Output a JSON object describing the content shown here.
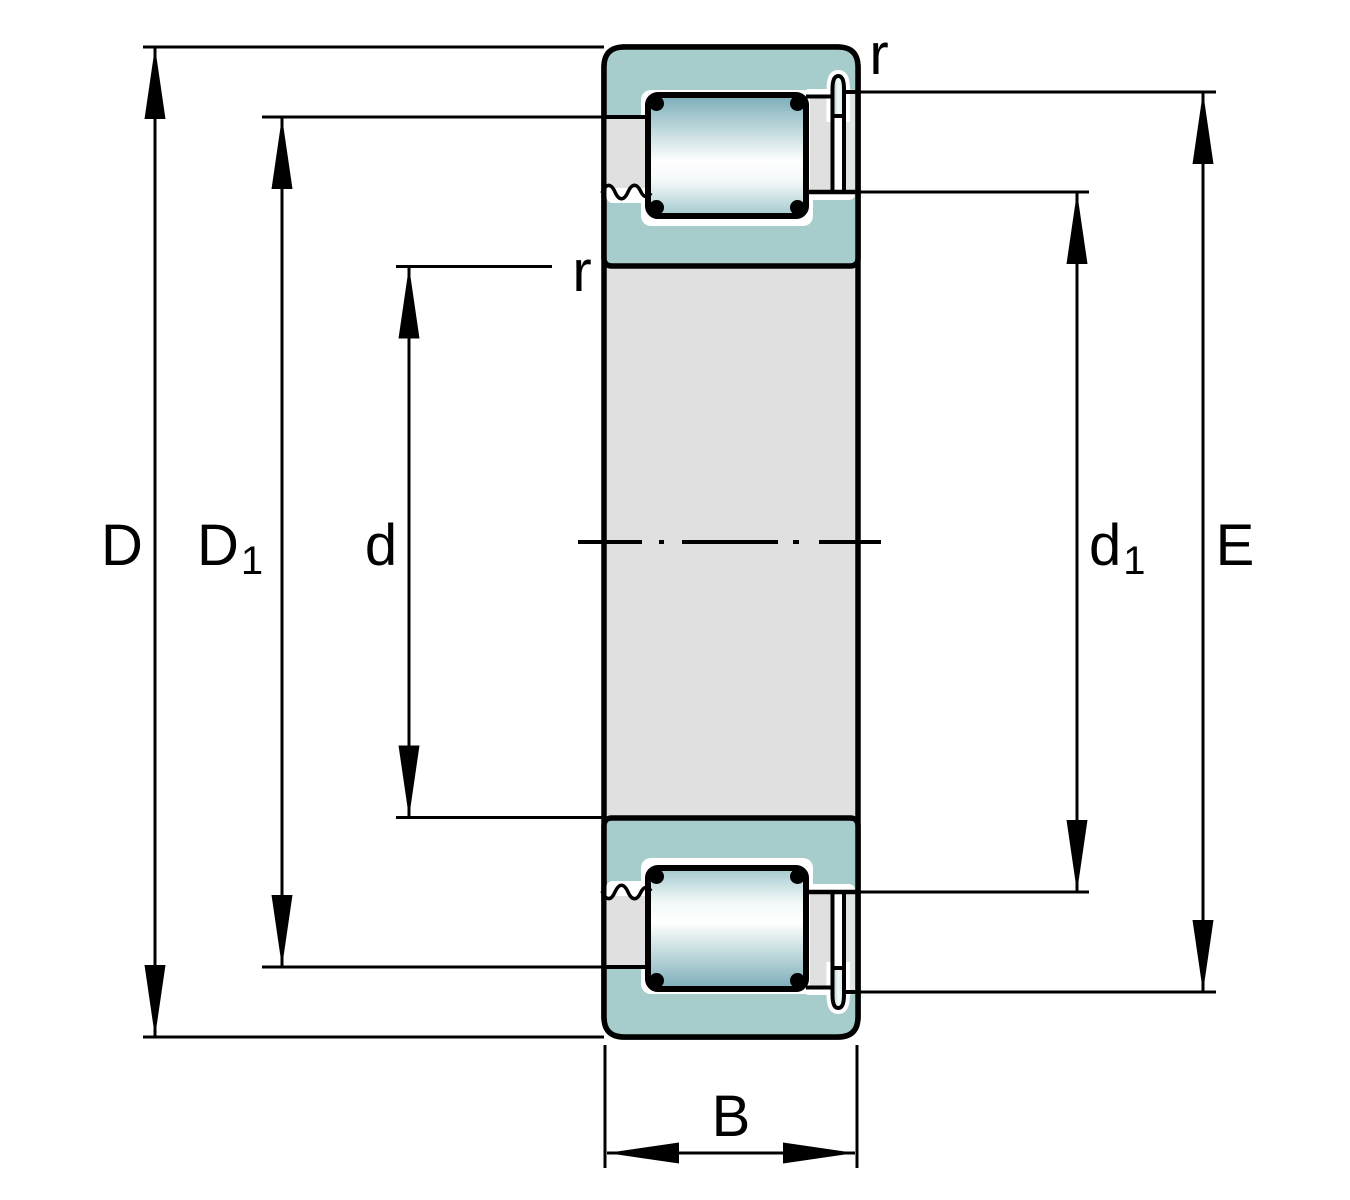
{
  "drawing": {
    "description": "Sectioned technical drawing of a single-row cylindrical roller bearing with boundary dimension lines",
    "labels": {
      "D": {
        "main": "D"
      },
      "D1": {
        "main": "D",
        "sub": "1"
      },
      "d": {
        "main": "d"
      },
      "d1": {
        "main": "d",
        "sub": "1"
      },
      "E": {
        "main": "E"
      },
      "B": {
        "main": "B"
      },
      "r_outer": {
        "main": "r"
      },
      "r_inner": {
        "main": "r"
      }
    },
    "colors": {
      "ring_teal": "#A6CCCB",
      "steel_gray": "#E0E0E0",
      "pale_band": "#DFE6E5",
      "outline": "#000000",
      "roller_top": "#7AACB8",
      "roller_mid": "#FFFFFF",
      "roller_bottom": "#A2C8CD",
      "background": "#FFFFFF"
    }
  }
}
